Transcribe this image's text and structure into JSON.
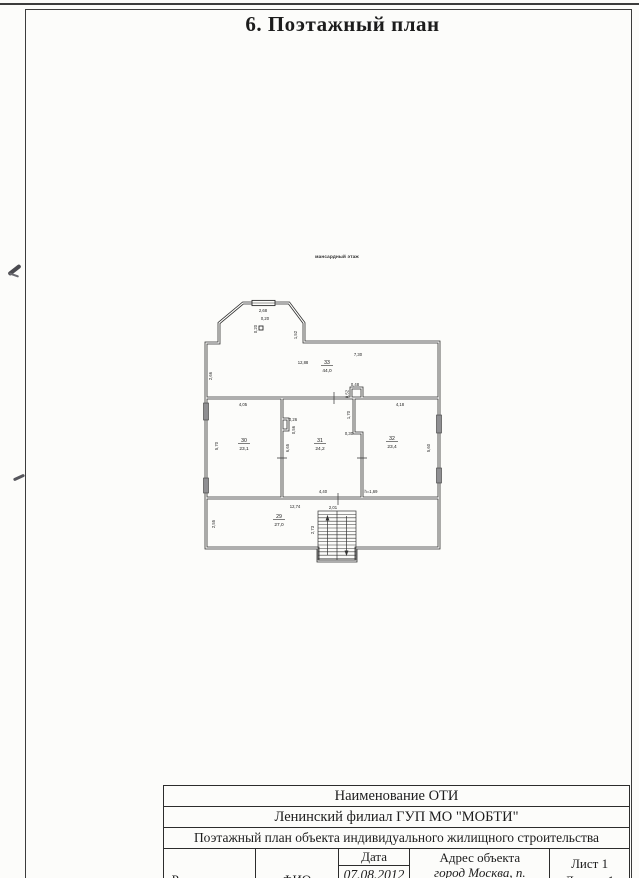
{
  "page": {
    "title": "6. Поэтажный план"
  },
  "colors": {
    "paper": "#fcfcfa",
    "ink": "#1c1c1c",
    "line": "#3c3c3c",
    "window_fill": "#8f8f92"
  },
  "plan": {
    "floor_label": "мансардный этаж",
    "rooms": {
      "r33": {
        "num": "33",
        "area": "44,0"
      },
      "r30": {
        "num": "30",
        "area": "23,1"
      },
      "r31": {
        "num": "31",
        "area": "24,2"
      },
      "r32": {
        "num": "32",
        "area": "23,4"
      },
      "r29": {
        "num": "29",
        "area": "27,0"
      }
    },
    "dims": {
      "bay_width": "2,68",
      "chimney_w": "0,20",
      "chimney_h": "0,20",
      "bay_side": "1,52",
      "top_right": "7,30",
      "r33_width": "12,88",
      "wall_left_upper": "2,66",
      "duct_w": "0,48",
      "duct_h": "0,52",
      "jog_len": "1,70",
      "jog_off": "0,30",
      "r30_w": "4,05",
      "r30_h": "5,70",
      "niche_w": "0,26",
      "niche_h": "0,56",
      "r31_wall": "6,65",
      "r31_w": "4,40",
      "r32_w": "4,18",
      "r32_h": "5,60",
      "h_note": "h=1,69",
      "r29_w": "12,74",
      "stair_w": "2,01",
      "r29_h": "2,55",
      "stair_len": "2,73"
    }
  },
  "table": {
    "rows": [
      "Наименование ОТИ",
      "Ленинский филиал ГУП МО \"МОБТИ\"",
      "Поэтажный план объекта индивидуального жилищного строительства"
    ],
    "footer": {
      "role": "Руководитель",
      "fio": "ФИО",
      "date_label": "Дата",
      "date_value": "07.08.2012",
      "address_label": "Адрес объекта",
      "address_line1": "город Москва, п.",
      "address_line2": "«Сосенское, с/т \"Лесная",
      "sheet": "Лист 1",
      "sheets": "Листов 1"
    }
  }
}
